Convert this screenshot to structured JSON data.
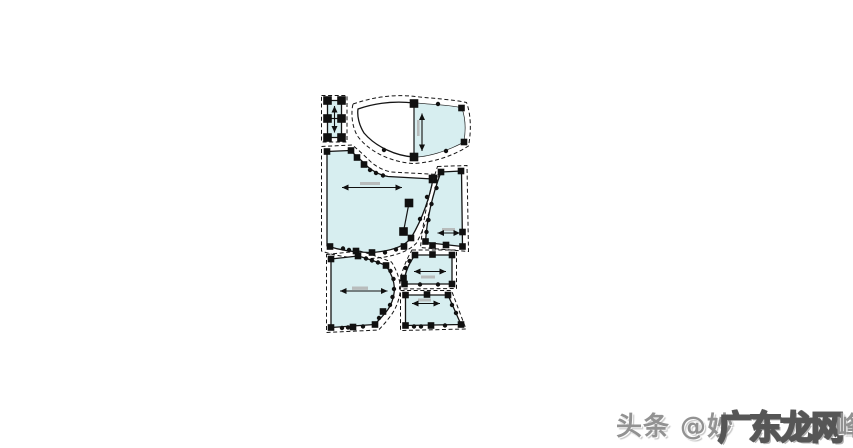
{
  "diagram": {
    "description": "garment sewing pattern pieces (CAD pattern-making view)",
    "piece_count": 7,
    "piece_fill_color": "#d7eef0",
    "outline_color": "#141414",
    "node_color": "#101010",
    "seam_allowance_style": "dashed",
    "pieces": [
      {
        "id": "small-rectangle-band",
        "grainline": "vertical"
      },
      {
        "id": "curved-yoke",
        "grainline": "vertical"
      },
      {
        "id": "large-bodice-panel",
        "grainline": "horizontal"
      },
      {
        "id": "narrow-side-panel",
        "grainline": "horizontal"
      },
      {
        "id": "small-upper-panel",
        "grainline": "horizontal"
      },
      {
        "id": "small-lower-panel",
        "grainline": "horizontal"
      },
      {
        "id": "lower-left-panel",
        "grainline": "horizontal"
      }
    ]
  },
  "watermark": {
    "prefix": "头条 @妙",
    "overlay": "广东龙网",
    "suffix": "峰",
    "prefix_color": "#8d8d8d",
    "overlay_stroke_color": "#4d4d4d"
  }
}
